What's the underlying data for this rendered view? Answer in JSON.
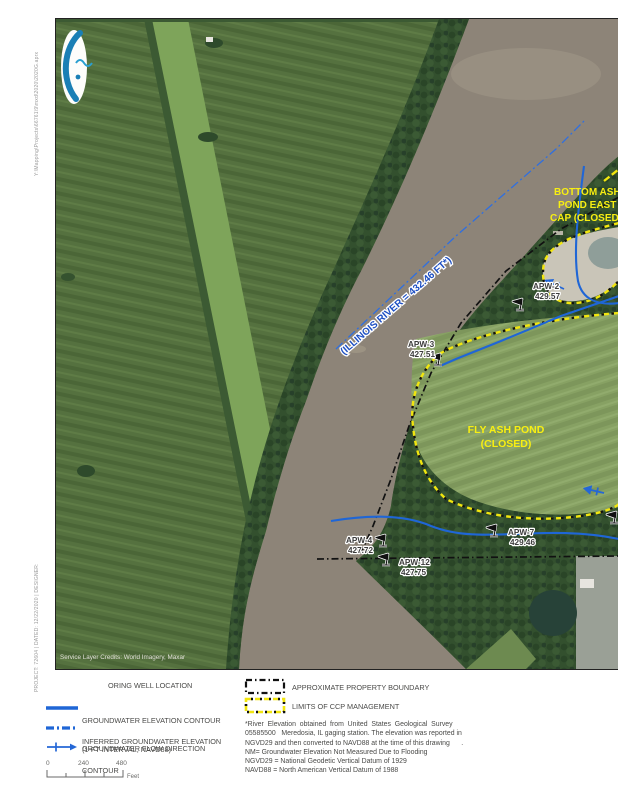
{
  "sidebar": {
    "top_text": "Y:\\Mapping\\Projects\\66761\\9\\mxd\\2020\\2020G.aprx",
    "bottom_text": "PROJECT: 72604 | DATED: 12/22/2020 | DESIGNER:"
  },
  "map": {
    "credits": "Service Layer Credits:  World Imagery, Maxar",
    "river_label": "(ILLINOIS RIVER = 432.46 FT*)",
    "fly_ash_pond_line1": "FLY ASH POND",
    "fly_ash_pond_line2": "(CLOSED)",
    "bottom_ash_line1": "BOTTOM ASH",
    "bottom_ash_line2": "POND EAST",
    "bottom_ash_line3": "CAP (CLOSED)",
    "wells": [
      {
        "id": "APW-2",
        "elev": "429.57"
      },
      {
        "id": "APW-3",
        "elev": "427.51"
      },
      {
        "id": "APW-4",
        "elev": "427.72"
      },
      {
        "id": "APW-7",
        "elev": "429.46"
      },
      {
        "id": "APW-12",
        "elev": "427.75"
      }
    ],
    "colors": {
      "contour_blue": "#1f66d6",
      "ccp_yellow": "#f2e60e",
      "boundary_black": "#111111",
      "label_yellow": "#f8ef12",
      "river_label_blue": "#1d4fc2"
    }
  },
  "legend": {
    "left": [
      {
        "label1": "ORING WELL LOCATION",
        "label2": ""
      },
      {
        "label1": "GROUNDWATER ELEVATION CONTOUR",
        "label2": "(1-FT INTERVAL, NAVD88)"
      },
      {
        "label1": "INFERRED GROUNDWATER ELEVATION",
        "label2": "CONTOUR"
      },
      {
        "label1": "GROUNDWATER FLOW DIRECTION",
        "label2": ""
      }
    ],
    "right": [
      {
        "label": "APPROXIMATE PROPERTY BOUNDARY"
      },
      {
        "label": "LIMITS OF CCP MANAGEMENT"
      }
    ],
    "scale": {
      "tick0": "0",
      "tick1": "240",
      "tick2": "480",
      "unit": "Feet"
    },
    "notes": [
      "*River  Elevation  obtained  from  United  States  Geological  Survey",
      "05585500   Meredosia, IL gaging station. The elevation was reported in",
      "NGVD29 and then converted to NAVD88 at the time of this drawing      .",
      "NM= Groundwater Elevation Not Measured Due to Flooding",
      "NGVD29 = National Geodetic Vertical Datum of 1929",
      "NAVD88 = North American Vertical Datum of 1988"
    ]
  }
}
